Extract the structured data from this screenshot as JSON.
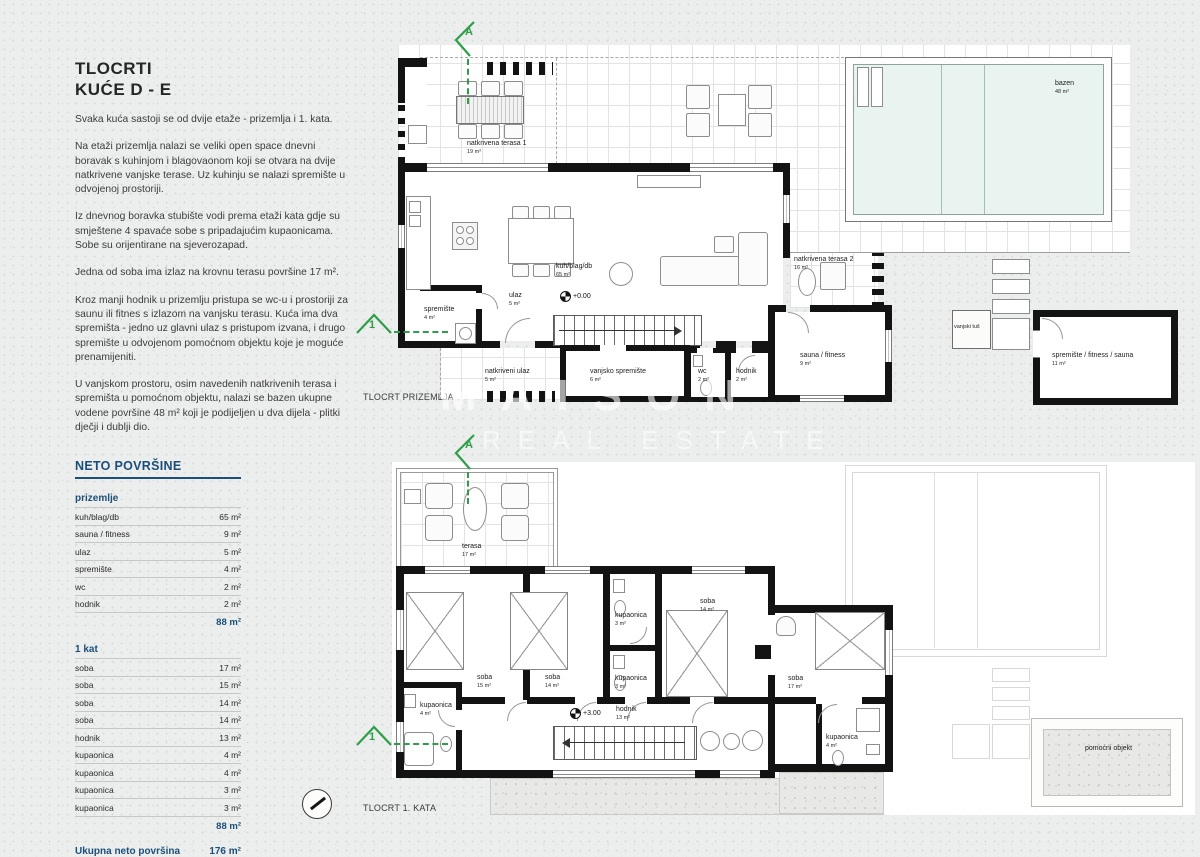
{
  "watermark": {
    "line1": "MAISON",
    "line2": "REAL ESTATE"
  },
  "sidebar": {
    "title_line1": "TLOCRTI",
    "title_line2": "KUĆE D - E",
    "paragraphs": [
      "Svaka kuća sastoji se od dvije etaže - prizemlja i 1. kata.",
      "Na etaži prizemlja nalazi se veliki open space dnevni boravak s kuhinjom i blagovaonom koji se otvara na dvije natkrivene vanjske terase. Uz kuhinju se nalazi spremište u odvojenoj prostoriji.",
      "Iz dnevnog boravka stubište vodi prema etaži kata gdje su smještene 4 spavaće sobe s pripadajućim kupaonicama. Sobe su orijentirane na sjeverozapad.",
      "Jedna od soba ima izlaz na krovnu terasu površine 17 m².",
      "Kroz manji hodnik u prizemlju pristupa se wc-u i prostoriji za saunu ili fitnes s izlazom na vanjsku terasu. Kuća ima dva spremišta - jedno uz glavni ulaz s pristupom izvana, i drugo spremište u odvojenom pomoćnom objektu koje je moguće prenamijeniti.",
      "U vanjskom prostoru, osim navedenih natkrivenih terasa i spremišta u pomoćnom objektu, nalazi se bazen ukupne vodene površine 48 m² koji je podijeljen u dva dijela - plitki dječji i dublji dio."
    ],
    "areas_table": {
      "title": "NETO POVRŠINE",
      "sections": [
        {
          "heading": "prizemlje",
          "rows": [
            {
              "label": "kuh/blag/db",
              "value": "65 m²"
            },
            {
              "label": "sauna / fitness",
              "value": "9 m²"
            },
            {
              "label": "ulaz",
              "value": "5 m²"
            },
            {
              "label": "spremište",
              "value": "4 m²"
            },
            {
              "label": "wc",
              "value": "2 m²"
            },
            {
              "label": "hodnik",
              "value": "2 m²"
            }
          ],
          "subtotal": "88 m²"
        },
        {
          "heading": "1 kat",
          "rows": [
            {
              "label": "soba",
              "value": "17 m²"
            },
            {
              "label": "soba",
              "value": "15 m²"
            },
            {
              "label": "soba",
              "value": "14 m²"
            },
            {
              "label": "soba",
              "value": "14 m²"
            },
            {
              "label": "hodnik",
              "value": "13 m²"
            },
            {
              "label": "kupaonica",
              "value": "4 m²"
            },
            {
              "label": "kupaonica",
              "value": "4 m²"
            },
            {
              "label": "kupaonica",
              "value": "3 m²"
            },
            {
              "label": "kupaonica",
              "value": "3 m²"
            }
          ],
          "subtotal": "88 m²"
        }
      ],
      "total_label": "Ukupna neto površina",
      "total_value": "176 m²"
    }
  },
  "ground_floor": {
    "caption": "TLOCRT PRIZEMLJA",
    "elevation": "+0.00",
    "section_mark_a": "A",
    "section_mark_1": "1",
    "rooms": [
      {
        "name": "natkrivena terasa 1",
        "area": "19 m²"
      },
      {
        "name": "kuh/blag/db",
        "area": "65 m²"
      },
      {
        "name": "ulaz",
        "area": "5 m²"
      },
      {
        "name": "spremište",
        "area": "4 m²"
      },
      {
        "name": "natkriveni ulaz",
        "area": "5 m²"
      },
      {
        "name": "vanjsko spremište",
        "area": "6 m²"
      },
      {
        "name": "wc",
        "area": "2 m²"
      },
      {
        "name": "hodnik",
        "area": "2 m²"
      },
      {
        "name": "natkrivena terasa 2",
        "area": "16 m²"
      },
      {
        "name": "sauna / fitness",
        "area": "9 m²"
      },
      {
        "name": "vanjski tuš",
        "area": ""
      },
      {
        "name": "spremište / fitness / sauna",
        "area": "11 m²"
      },
      {
        "name": "bazen",
        "area": "48 m²"
      }
    ]
  },
  "first_floor": {
    "caption": "TLOCRT 1. KATA",
    "elevation": "+3.00",
    "section_mark_a": "A",
    "section_mark_1": "1",
    "rooms": [
      {
        "name": "terasa",
        "area": "17 m²"
      },
      {
        "name": "soba",
        "area": "15 m²"
      },
      {
        "name": "soba",
        "area": "14 m²"
      },
      {
        "name": "kupaonica",
        "area": "3 m²"
      },
      {
        "name": "soba",
        "area": "14 m²"
      },
      {
        "name": "kupaonica",
        "area": "3 m²"
      },
      {
        "name": "soba",
        "area": "17 m²"
      },
      {
        "name": "hodnik",
        "area": "13 m²"
      },
      {
        "name": "kupaonica",
        "area": "4 m²"
      },
      {
        "name": "kupaonica",
        "area": "4 m²"
      },
      {
        "name": "pomoćni objekt",
        "area": ""
      }
    ]
  }
}
